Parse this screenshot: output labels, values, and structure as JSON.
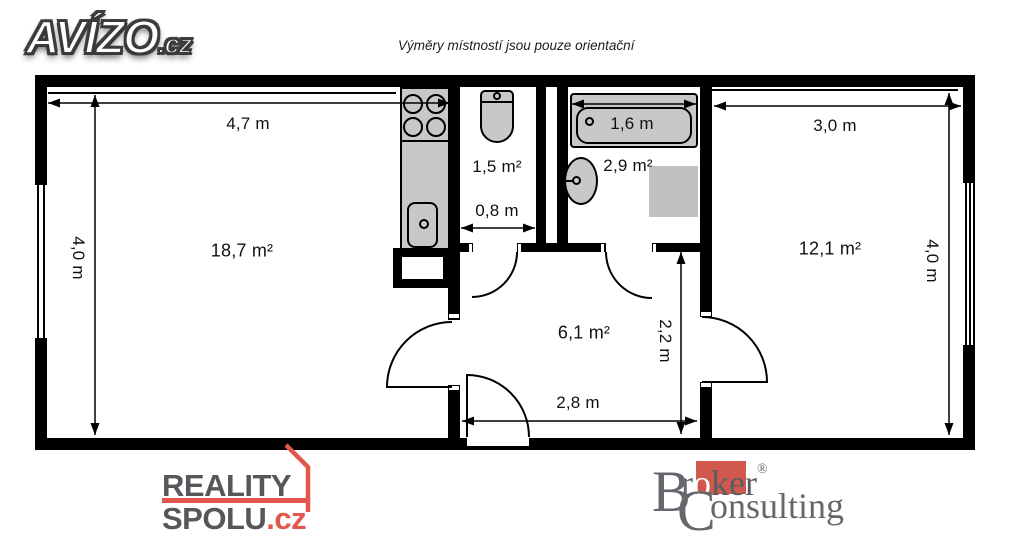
{
  "header": {
    "brand": "AVÍZO",
    "brand_suffix": ".cz",
    "disclaimer": "Výměry místností jsou pouze orientační"
  },
  "plan": {
    "rooms": {
      "living_room": {
        "area": "18,7 m²"
      },
      "wc": {
        "area": "1,5 m²"
      },
      "bathroom": {
        "area": "2,9 m²"
      },
      "hall": {
        "area": "6,1 m²"
      },
      "bedroom": {
        "area": "12,1 m²"
      }
    },
    "dimensions": {
      "living_width": "4,7 m",
      "living_height": "4,0 m",
      "wc_width": "0,8 m",
      "bathtub_length": "1,6 m",
      "bedroom_width": "3,0 m",
      "bedroom_height": "4,0 m",
      "hall_depth": "2,2 m",
      "hall_width": "2,8 m"
    },
    "colors": {
      "wall": "#000000",
      "fixture_fill": "#c8c8c8",
      "appliance_fill": "#c1c1c1"
    }
  },
  "footer": {
    "reality_spolu": {
      "line1": "REALITY",
      "line2": "SPOLU",
      "tld": ".cz",
      "accent": "#e2574b"
    },
    "broker_consulting": {
      "b": "B",
      "r": "r",
      "o": "o",
      "ker": "ker",
      "registered": "®",
      "c": "C",
      "onsulting": "onsulting",
      "accent": "#d0584d"
    }
  }
}
